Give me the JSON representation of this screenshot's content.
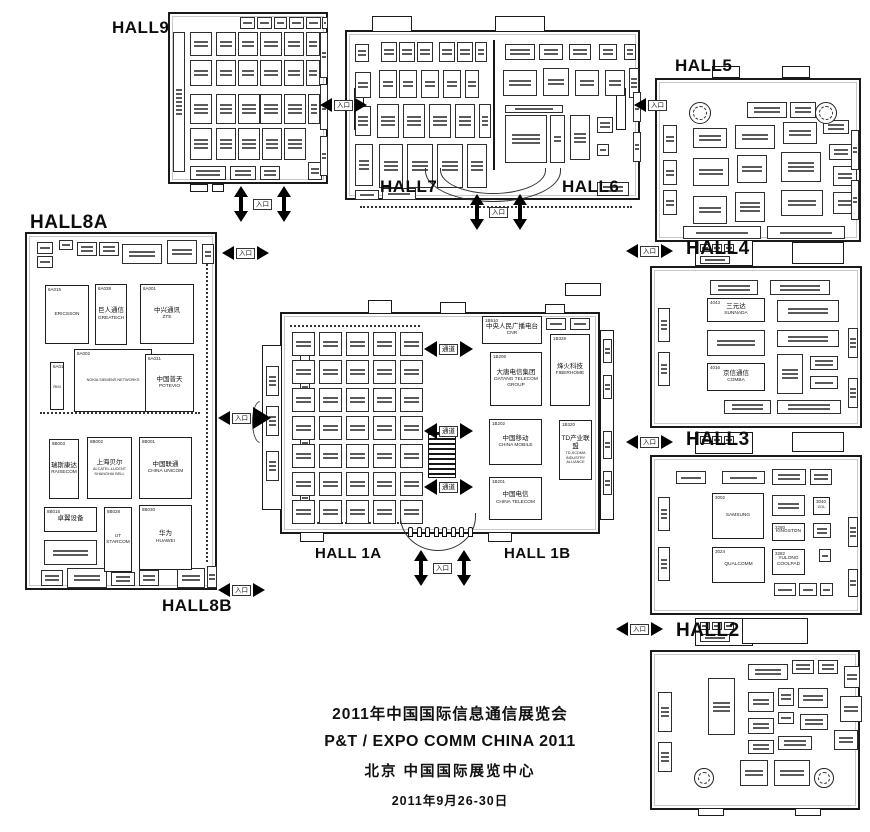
{
  "event": {
    "title_cn": "2011年中国国际信息通信展览会",
    "title_en": "P&T / EXPO COMM CHINA 2011",
    "venue": "北京  中国国际展览中心",
    "dates": "2011年9月26-30日"
  },
  "halls": {
    "h9": "HALL9",
    "h8a": "HALL8A",
    "h8b": "HALL8B",
    "h7": "HALL7",
    "h6": "HALL6",
    "h5": "HALL5",
    "h4": "HALL4",
    "h3": "HALL3",
    "h2": "HALL2",
    "h1a": "HALL 1A",
    "h1b": "HALL 1B"
  },
  "markers": {
    "entrance": "入口",
    "aisle": "通道"
  },
  "booths": {
    "h8a": [
      {
        "no": "8A015",
        "cn": "",
        "en": "ERICSSON"
      },
      {
        "no": "8A038",
        "cn": "巨人通信",
        "en": "GREATECH"
      },
      {
        "no": "8A001",
        "cn": "中兴通讯",
        "en": "ZTE"
      },
      {
        "no": "8A002",
        "cn": "",
        "en": "NOKIA SIEMENS NETWORKS"
      },
      {
        "no": "8A031",
        "cn": "中国普天",
        "en": "POTEVIO"
      },
      {
        "no": "8A016",
        "cn": "",
        "en": "RIM"
      }
    ],
    "h8b": [
      {
        "no": "8B003",
        "cn": "瑞斯康达",
        "en": "RAISECOM"
      },
      {
        "no": "8B002",
        "cn": "上海贝尔",
        "en": "ALCATEL-LUCENT SHANGHAI BELL"
      },
      {
        "no": "8B001",
        "cn": "中国联通",
        "en": "CHINA UNICOM"
      },
      {
        "no": "8B015",
        "cn": "卓翼设备",
        "en": ""
      },
      {
        "no": "8B028",
        "cn": "",
        "en": "UT STARCOM"
      },
      {
        "no": "8B030",
        "cn": "华为",
        "en": "HUAWEI"
      }
    ],
    "h1b": [
      {
        "no": "1B510",
        "cn": "中央人民广播电台",
        "en": "CNR"
      },
      {
        "no": "1B206",
        "cn": "大唐电信集团",
        "en": "DATANG TELECOM GROUP"
      },
      {
        "no": "1B328",
        "cn": "烽火科技",
        "en": "FIBERHOME"
      },
      {
        "no": "1B202",
        "cn": "中国移动",
        "en": "CHINA MOBILE"
      },
      {
        "no": "1B320",
        "cn": "TD产业联盟",
        "en": "TD-SCDMA INDUSTRY ALLIANCE"
      },
      {
        "no": "1B201",
        "cn": "中国电信",
        "en": "CHINA TELECOM"
      }
    ],
    "h4": [
      {
        "no": "4043",
        "cn": "三元达",
        "en": "SUNNADA"
      },
      {
        "no": "4016",
        "cn": "京信通信",
        "en": "COMBA"
      }
    ],
    "h3": [
      {
        "no": "3002",
        "cn": "",
        "en": "SAMSUNG"
      },
      {
        "no": "3024",
        "cn": "",
        "en": "QUALCOMM"
      },
      {
        "no": "3040",
        "cn": "",
        "en": "ZOL"
      },
      {
        "no": "3280",
        "cn": "",
        "en": "KINGSTON"
      },
      {
        "no": "3282",
        "cn": "",
        "en": "YULONG COOLPAD"
      }
    ]
  }
}
